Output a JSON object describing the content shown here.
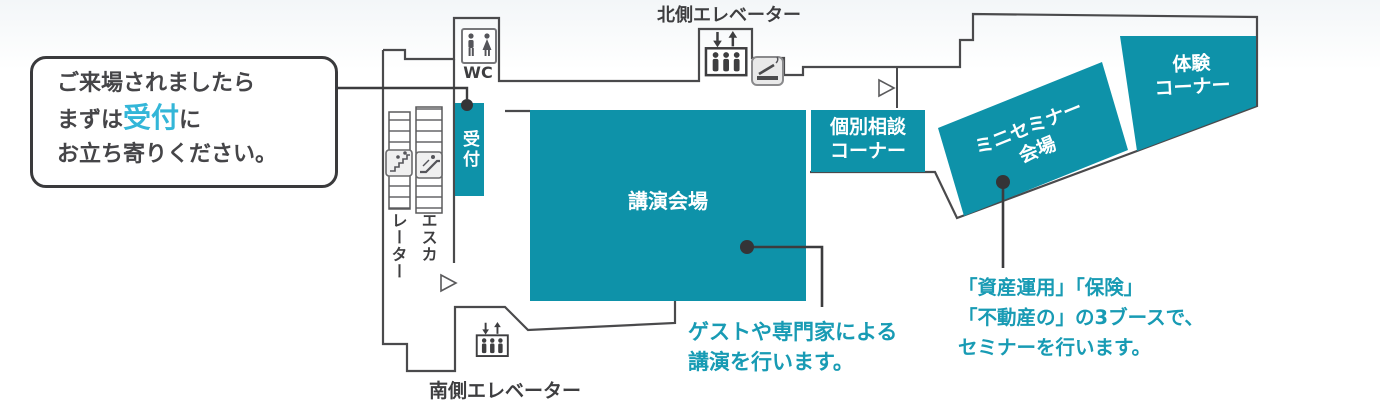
{
  "colors": {
    "room_fill": "#0e92a9",
    "accent_text": "#189bb4",
    "callout_highlight": "#33b6d8",
    "wall": "#4a4a4c",
    "dark_text": "#3e3e40"
  },
  "callout": {
    "line1": "ご来場されましたら",
    "line2_pre": "まずは",
    "line2_highlight": "受付",
    "line2_post": "に",
    "line3": "お立ち寄りください。"
  },
  "rooms": {
    "reception": "受付",
    "lecture_hall": "講演会場",
    "consultation_line1": "個別相談",
    "consultation_line2": "コーナー",
    "mini_seminar_line1": "ミニセミナー",
    "mini_seminar_line2": "会場",
    "experience_line1": "体験",
    "experience_line2": "コーナー"
  },
  "facilities": {
    "north_elevator": "北側エレベーター",
    "south_elevator": "南側エレベーター",
    "wc": "WC",
    "escalator_col_right": "エスカ",
    "escalator_col_left": "レーター"
  },
  "notes": {
    "lecture_line1": "ゲストや専門家による",
    "lecture_line2": "講演を行います。",
    "seminar_line1": "「資産運用」「保険」",
    "seminar_line2": "「不動産の」の3ブースで、",
    "seminar_line3": "セミナーを行います。"
  }
}
